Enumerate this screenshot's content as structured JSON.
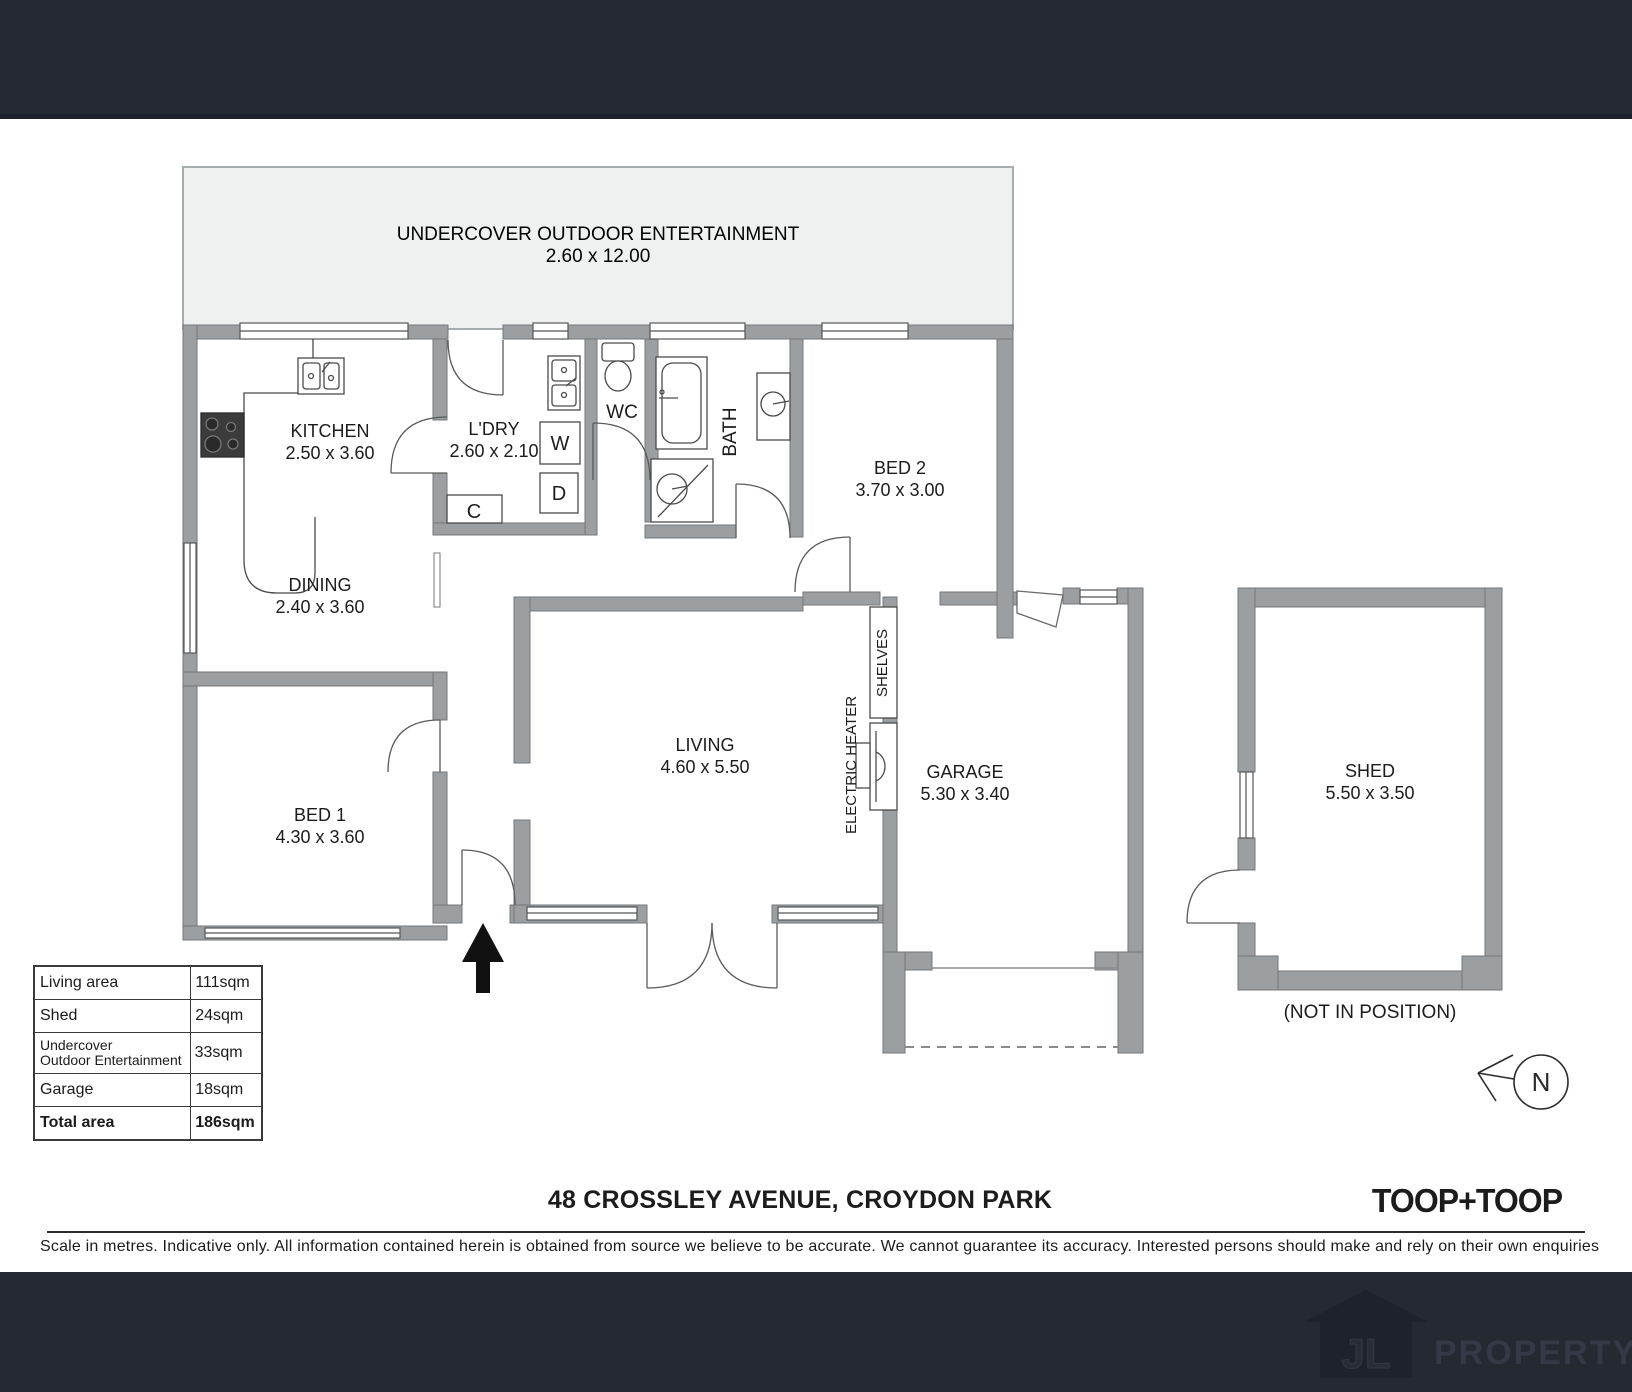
{
  "plan": {
    "outdoor": {
      "name": "UNDERCOVER OUTDOOR ENTERTAINMENT",
      "dims": "2.60 x 12.00"
    },
    "kitchen": {
      "name": "KITCHEN",
      "dims": "2.50 x 3.60"
    },
    "laundry": {
      "name": "L'DRY",
      "dims": "2.60 x 2.10"
    },
    "wc": {
      "name": "WC"
    },
    "bath": {
      "name": "BATH"
    },
    "bed2": {
      "name": "BED 2",
      "dims": "3.70 x 3.00"
    },
    "dining": {
      "name": "DINING",
      "dims": "2.40 x 3.60"
    },
    "living": {
      "name": "LIVING",
      "dims": "4.60 x 5.50"
    },
    "bed1": {
      "name": "BED 1",
      "dims": "4.30 x 3.60"
    },
    "garage": {
      "name": "GARAGE",
      "dims": "5.30 x 3.40"
    },
    "shed": {
      "name": "SHED",
      "dims": "5.50 x 3.50",
      "note": "(NOT IN POSITION)"
    },
    "labels": {
      "shelves": "SHELVES",
      "electric_heater": "ELECTRIC HEATER",
      "washer": "W",
      "dryer": "D",
      "cupboard": "C"
    },
    "compass": {
      "north": "N"
    }
  },
  "area_table": {
    "rows": [
      {
        "label": "Living area",
        "value": "111sqm"
      },
      {
        "label": "Shed",
        "value": "24sqm"
      },
      {
        "label": "Undercover",
        "label2": "Outdoor Entertainment",
        "value": "33sqm"
      },
      {
        "label": "Garage",
        "value": "18sqm"
      },
      {
        "label": "Total area",
        "value": "186sqm"
      }
    ]
  },
  "footer_info": {
    "address": "48 CROSSLEY AVENUE, CROYDON PARK",
    "brand": "TOOP+TOOP",
    "disclaimer": "Scale in metres. Indicative only. All information contained herein is obtained from source we believe to be accurate. We cannot guarantee its accuracy. Interested persons should make and rely on their own enquiries"
  },
  "watermark": {
    "monogram": "JL",
    "word": "PROPERTY"
  },
  "colors": {
    "band": "#242932",
    "wall": "#9b9fa1",
    "wall_stroke": "#747779",
    "outdoor_fill": "#eff1f1",
    "line": "#4a4a4a",
    "logo_house": "#1d222c",
    "logo_word": "#333947"
  }
}
